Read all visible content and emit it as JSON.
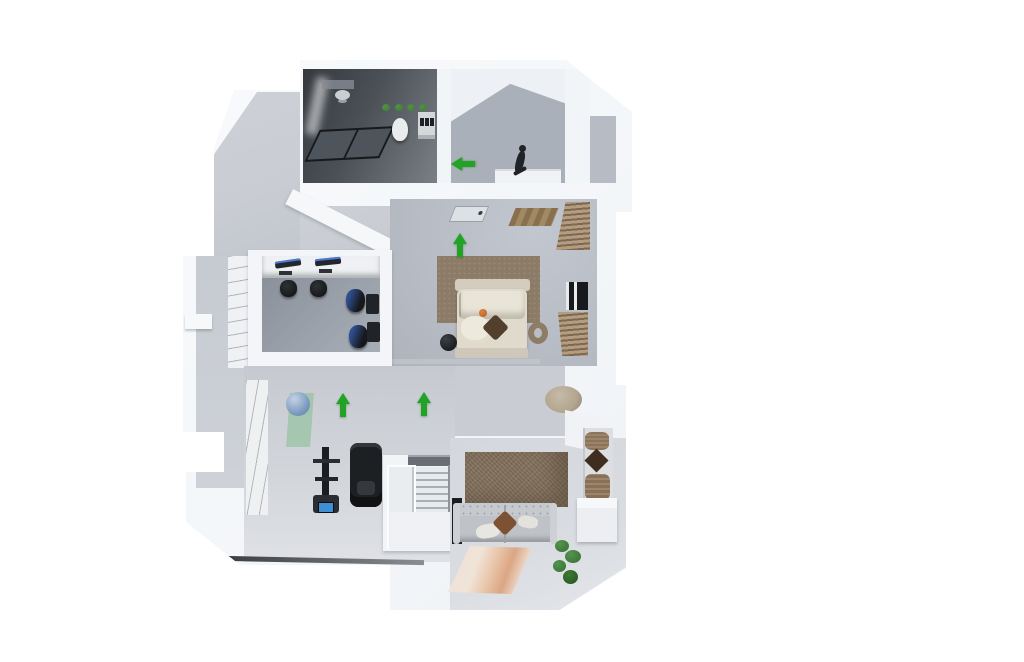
{
  "scene": {
    "type": "3d-floorplan-render",
    "view": "isometric-top-down",
    "background": "#ffffff",
    "arrow_glyph": "direction-arrow"
  },
  "palette": {
    "arrow_green": "#23a325",
    "floor_foyer": "#c9cdd3",
    "floor_landing": "#aab0b9",
    "floor_bedroom": "#b8bdc5",
    "floor_office": "#9aa0a9",
    "floor_living": "#d9dce1",
    "bathroom_dark": "#4b5157",
    "accent_wall_brown": "#85735f",
    "rug_bedroom": "#8c7c67",
    "rug_peach_1": "#f0e3d7",
    "rug_peach_2": "#dba684",
    "bed_cream": "#e0dacd",
    "sofa_grey": "#bfc2c7",
    "pillow_rust": "#7c5134",
    "pillow_dark_brown": "#52402c",
    "wood": "#a08a64",
    "blinds_light": "#b49c80",
    "blinds_dark": "#7d6950",
    "window_dark": "#17191d",
    "equipment_black": "#1b1d21",
    "screen_blue": "#3f8fd6",
    "monitor_blue": "#4a79d8",
    "ball_blue": "#7e9cc0",
    "mat_green": "#8abf96",
    "plant_green": "#3e7a39",
    "threshold_dark": "#3a3d40",
    "person_dark": "#202328",
    "pouf_tan": "#b3a58f",
    "niche_pillow_tan": "#9d8468"
  },
  "arrows": [
    {
      "id": "landing-direction-arrow",
      "direction": "left",
      "x": 466,
      "y": 164
    },
    {
      "id": "bedroom-entry-arrow",
      "direction": "up",
      "x": 463,
      "y": 245
    },
    {
      "id": "hallway-arrow-left",
      "direction": "up",
      "x": 346,
      "y": 405
    },
    {
      "id": "hallway-arrow-right",
      "direction": "up",
      "x": 427,
      "y": 404
    }
  ],
  "rooms": [
    {
      "id": "bathroom",
      "contents": [
        "shower-head",
        "shower-glass-screen",
        "toilet",
        "plant-row",
        "bottle-shelf",
        "sink-counter"
      ]
    },
    {
      "id": "stair-landing",
      "contents": [
        "person-figure",
        "stair-counter",
        "balcony-strip"
      ]
    },
    {
      "id": "foyer",
      "contents": []
    },
    {
      "id": "bedroom",
      "contents": [
        "entry-door-panel",
        "wood-ceiling-panel",
        "upper-blinds",
        "window",
        "lower-blinds",
        "area-rug",
        "double-bed",
        "decor-sphere",
        "decor-ring"
      ]
    },
    {
      "id": "office",
      "contents": [
        "desk",
        "monitor",
        "monitor",
        "keyboard",
        "keyboard",
        "task-chair",
        "task-chair",
        "gaming-chair",
        "gaming-chair",
        "side-desk",
        "side-desk"
      ]
    },
    {
      "id": "hallway-gym",
      "contents": [
        "slat-panel",
        "yoga-mat",
        "exercise-ball",
        "power-tower",
        "exercise-machine",
        "dark-threshold"
      ]
    },
    {
      "id": "staircase",
      "contents": [
        "steps",
        "glass-balustrade",
        "handrail",
        "lower-landing"
      ]
    },
    {
      "id": "living-room",
      "contents": [
        "accent-wall",
        "sofa",
        "cushions",
        "area-rug",
        "plant",
        "speaker",
        "pouf",
        "shelf-niche",
        "cabinet"
      ]
    }
  ]
}
